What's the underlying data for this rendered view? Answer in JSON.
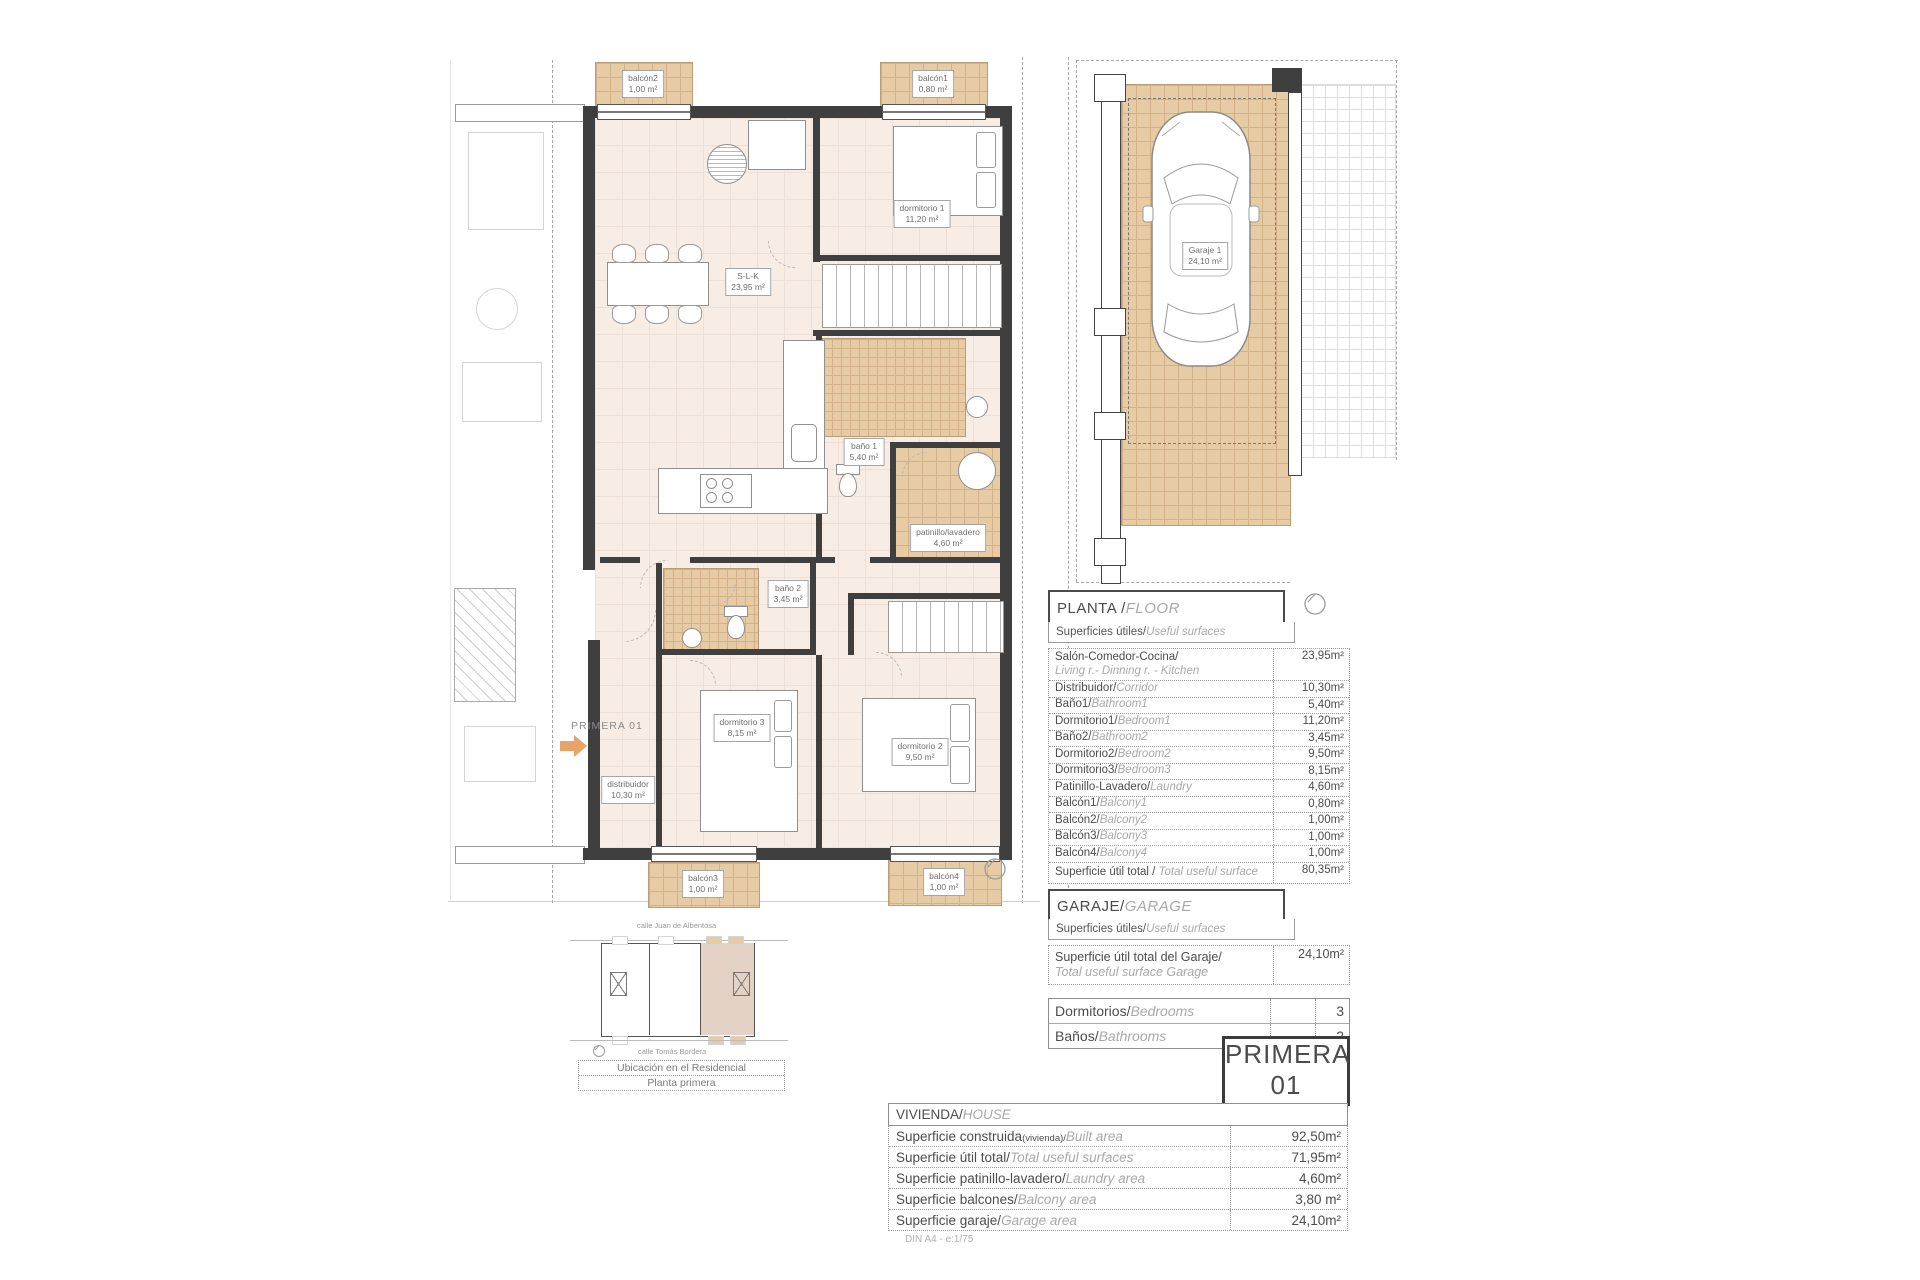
{
  "sheet": {
    "scale_note": "DIN A4 - e:1/75"
  },
  "floor_plan": {
    "unit_label": "PRIMERA 01",
    "rooms": [
      {
        "name": "S-L-K",
        "area": "23,95 m²"
      },
      {
        "name": "dormitorio 1",
        "area": "11,20 m²"
      },
      {
        "name": "baño 1",
        "area": "5,40 m²"
      },
      {
        "name": "patinillo/lavadero",
        "area": "4,60 m²"
      },
      {
        "name": "baño 2",
        "area": "3,45 m²"
      },
      {
        "name": "dormitorio 3",
        "area": "8,15 m²"
      },
      {
        "name": "dormitorio 2",
        "area": "9,50 m²"
      },
      {
        "name": "distribuidor",
        "area": "10,30 m²"
      }
    ],
    "balconies": [
      {
        "name": "balcón2",
        "area": "1,00 m²"
      },
      {
        "name": "balcón1",
        "area": "0,80 m²"
      },
      {
        "name": "balcón3",
        "area": "1,00 m²"
      },
      {
        "name": "balcón4",
        "area": "1,00 m²"
      }
    ]
  },
  "garage_plan": {
    "name": "Garaje 1",
    "area": "24,10 m²"
  },
  "planta": {
    "title_es": "PLANTA / ",
    "title_en": "FLOOR",
    "sub_es": "Superficies útiles/",
    "sub_en": "Useful surfaces",
    "rows": [
      {
        "es": "Salón-Comedor-Cocina/",
        "en": "Living r.- Dinning r. - Kitchen",
        "value": "23,95m²"
      },
      {
        "es": "Distribuidor/",
        "en": "Corridor",
        "value": "10,30m²"
      },
      {
        "es": "Baño1/",
        "en": "Bathroom1",
        "value": "5,40m²"
      },
      {
        "es": "Dormitorio1/",
        "en": "Bedroom1",
        "value": "11,20m²"
      },
      {
        "es": "Baño2/",
        "en": "Bathroom2",
        "value": "3,45m²"
      },
      {
        "es": "Dormitorio2/",
        "en": "Bedroom2",
        "value": "9,50m²"
      },
      {
        "es": "Dormitorio3/",
        "en": "Bedroom3",
        "value": "8,15m²"
      },
      {
        "es": "Patinillo-Lavadero/",
        "en": "Laundry",
        "value": "4,60m²"
      },
      {
        "es": "Balcón1/",
        "en": "Balcony1",
        "value": "0,80m²"
      },
      {
        "es": "Balcón2/",
        "en": "Balcony2",
        "value": "1,00m²"
      },
      {
        "es": "Balcón3/",
        "en": "Balcony3",
        "value": "1,00m²"
      },
      {
        "es": "Balcón4/",
        "en": "Balcony4",
        "value": "1,00m²"
      },
      {
        "es": "Superficie útil total / ",
        "en": "Total useful surface",
        "value": "80,35m²"
      }
    ]
  },
  "garaje": {
    "title_es": "GARAJE/",
    "title_en": "GARAGE",
    "sub_es": "Superficies útiles/",
    "sub_en": "Useful surfaces",
    "total_es": "Superficie útil total del Garaje/",
    "total_en": "Total useful surface Garage",
    "total_value": "24,10m²"
  },
  "counts": {
    "rows": [
      {
        "es": "Dormitorios/",
        "en": "Bedrooms",
        "value": "3"
      },
      {
        "es": "Baños/",
        "en": "Bathrooms",
        "value": "2"
      }
    ]
  },
  "unit_badge": {
    "line1": "PRIMERA",
    "line2": "01"
  },
  "vivienda": {
    "header_es": "VIVIENDA/",
    "header_en": "HOUSE",
    "rows": [
      {
        "es": "Superficie construida",
        "note": "(vivienda)/",
        "en": "Built area",
        "value": "92,50m²"
      },
      {
        "es": "Superficie útil total/",
        "en": "Total useful surfaces",
        "value": "71,95m²"
      },
      {
        "es": "Superficie patinillo-lavadero/",
        "en": "Laundry area",
        "value": "4,60m²"
      },
      {
        "es": "Superficie balcones/",
        "en": "Balcony area",
        "value": "3,80 m²"
      },
      {
        "es": "Superficie garaje/",
        "en": "Garage area",
        "value": "24,10m²"
      }
    ]
  },
  "site_plan": {
    "street_top": "calle Juan de Albentosa",
    "street_bottom": "calle Tomás Bordera",
    "caption_line1": "Ubicación en el Residencial",
    "caption_line2": "Planta primera"
  },
  "colors": {
    "accent_orange": "#e8a368",
    "tan": "#e7cba5",
    "cream": "#f8ede5",
    "wall": "#3f3f3f"
  }
}
